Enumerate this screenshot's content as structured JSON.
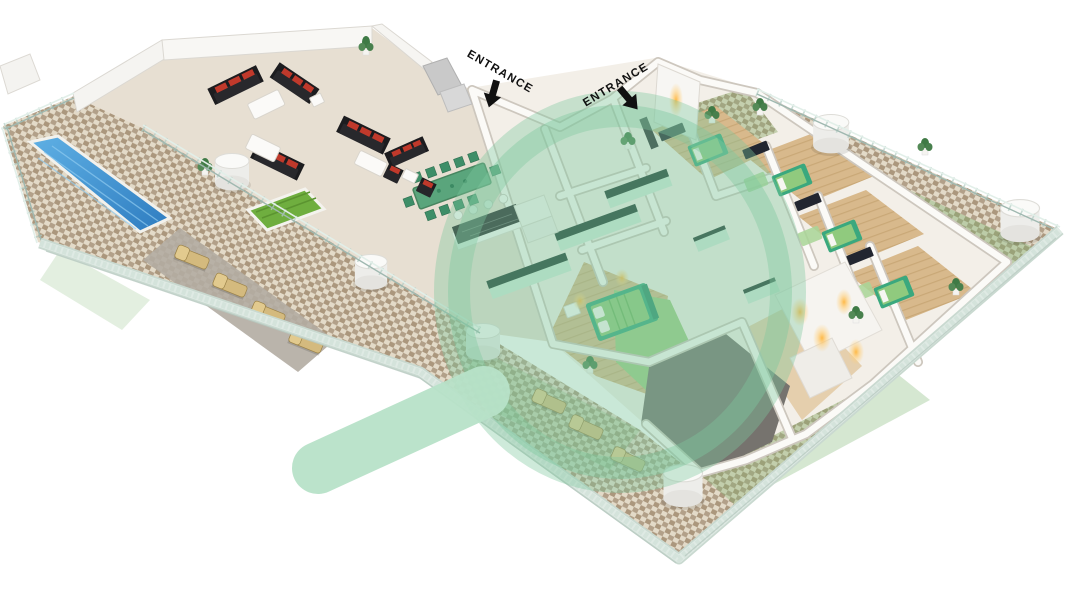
{
  "labels": {
    "entrance_1": "ENTRANCE",
    "entrance_2": "ENTRANCE"
  },
  "icons": {
    "entrance_arrow_1": "arrow-down-icon",
    "entrance_arrow_2": "arrow-down-icon",
    "watermark": "magnifier-watermark"
  },
  "colors": {
    "background": "#ffffff",
    "watermark_fill": "#7ec89f",
    "watermark_ring": "#7ec89f",
    "watermark_handle": "#b7e2c8",
    "pool_water": "#3d8ed2",
    "terrace_floor": "#e7dfd2",
    "tile_light": "#e3dac8",
    "tile_dark": "#b2a089",
    "lawn": "#6fae3f",
    "sofa": "#232326",
    "sofa_cushion": "#c0392b",
    "dining_set": "#5aa57c",
    "bed_green": "#8cc87a",
    "wood_floor": "#d8b98c",
    "dark_terrace": "#76736e",
    "closet_glow": "#ffb63e",
    "wall": "#fbfaf7",
    "fence_glass": "#c9d9d0",
    "label_text": "#101010"
  }
}
